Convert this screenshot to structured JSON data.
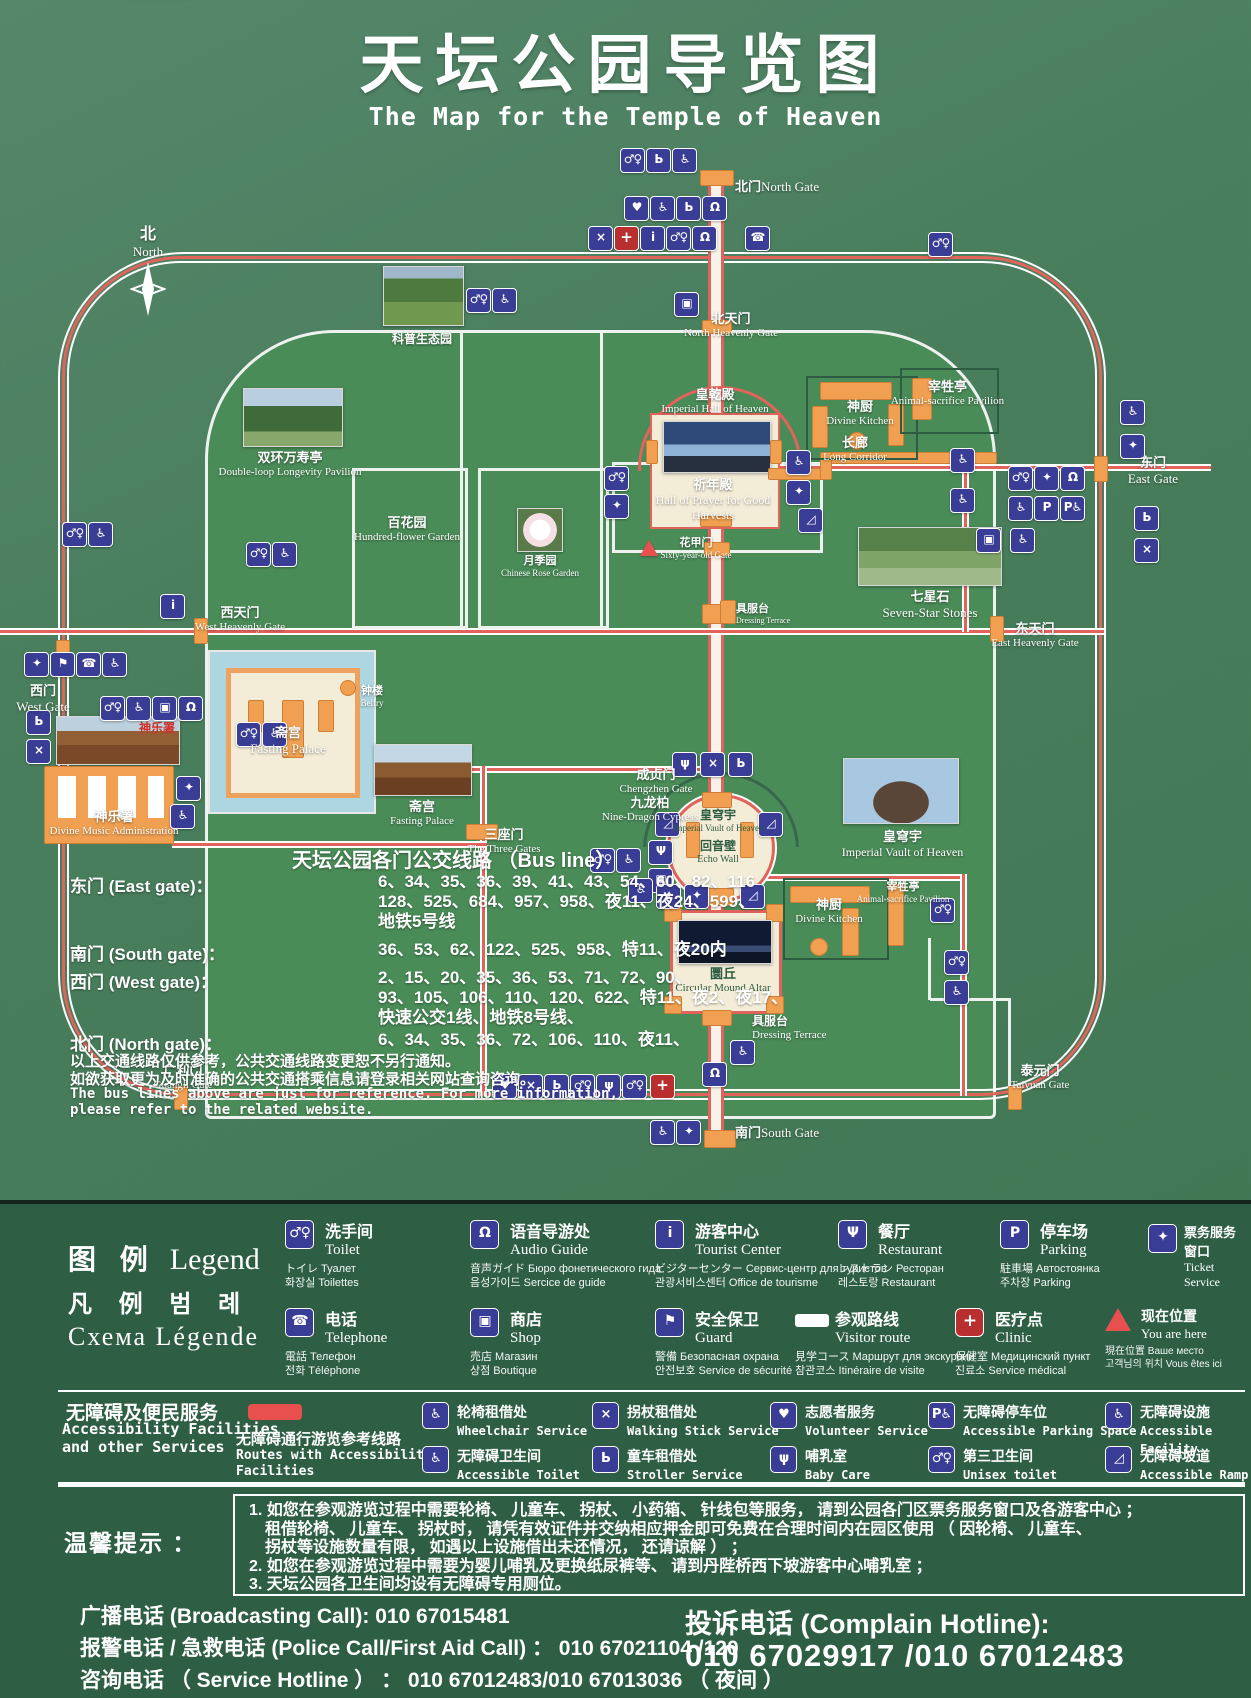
{
  "title": {
    "zh": "天坛公园导览图",
    "en": "The Map for the Temple of Heaven"
  },
  "colors": {
    "board_green": "#4a7f5e",
    "park_green": "#4a8c58",
    "panel_green": "#2e5f44",
    "route_red": "#e0635c",
    "icon_blue": "#3a3d96",
    "building_orange": "#f0a050",
    "moat_blue": "#aed6e0",
    "cream": "#f3ecd7",
    "marker_red": "#e85050"
  },
  "icons": {
    "toilet": "♂♀",
    "acc_toilet": "♿",
    "accessible": "♿",
    "wheelchair": "♿",
    "phone": "☎",
    "info": "i",
    "restaurant": "Ψ",
    "parking": "P",
    "acc_parking": "P♿",
    "ticket": "✦",
    "audio": "Ω",
    "shop": "▣",
    "guard": "⚑",
    "clinic": "+",
    "volunteer": "♥",
    "walking": "×",
    "stroller": "Ь",
    "baby": "ψ",
    "unisex": "♂♀",
    "ramp": "◿"
  },
  "features": {
    "compass": {
      "zh": "北",
      "en": "North"
    },
    "north_gate": {
      "zh": "北门",
      "en": "North Gate"
    },
    "north_heavenly": {
      "zh": "北天门",
      "en": "North Heavenly Gate"
    },
    "science_garden": {
      "zh": "科普生态园",
      "en": ""
    },
    "double_loop": {
      "zh": "双环万寿亭",
      "en": "Double-loop Longevity Pavilion"
    },
    "imperial_hall": {
      "zh": "皇乾殿",
      "en": "Imperial Hall of Heaven"
    },
    "hall_prayer": {
      "zh": "祈年殿",
      "en": "Hall of Prayer for Good Harvests"
    },
    "divine_kitchen": {
      "zh": "神厨",
      "en": "Divine Kitchen"
    },
    "animal_pavilion": {
      "zh": "宰牲亭",
      "en": "Animal-sacrifice Pavilion"
    },
    "long_corridor": {
      "zh": "长廊",
      "en": "Long Corridor"
    },
    "east_gate": {
      "zh": "东门",
      "en": "East Gate"
    },
    "hundred_flower": {
      "zh": "百花园",
      "en": "Hundred-flower Garden"
    },
    "rose_garden": {
      "zh": "月季园",
      "en": "Chinese Rose Garden"
    },
    "sixty_gate": {
      "zh": "花甲门",
      "en": "Sixty-year-old Gate"
    },
    "seven_star": {
      "zh": "七星石",
      "en": "Seven-Star Stones"
    },
    "west_heavenly": {
      "zh": "西天门",
      "en": "West Heavenly Gate"
    },
    "west_gate": {
      "zh": "西门",
      "en": "West Gate"
    },
    "east_heavenly": {
      "zh": "东天门",
      "en": "East Heavenly Gate"
    },
    "dressing": {
      "zh": "具服台",
      "en": "Dressing Terrace"
    },
    "belfry": {
      "zh": "钟楼",
      "en": "Belfry"
    },
    "fasting_palace": {
      "zh": "斋宫",
      "en": "Fasting Palace"
    },
    "divine_music": {
      "zh": "神乐署",
      "en": "Divine Music Administration"
    },
    "chengzhen": {
      "zh": "成贞门",
      "en": "Chengzhen Gate"
    },
    "nine_dragon": {
      "zh": "九龙柏",
      "en": "Nine-Dragon Cypress"
    },
    "imperial_vault": {
      "zh": "皇穹宇",
      "en": "Imperial Vault of Heaven"
    },
    "echo_wall": {
      "zh": "回音壁",
      "en": "Echo Wall"
    },
    "three_gates": {
      "zh": "三座门",
      "en": "The Three Gates"
    },
    "circular_mound": {
      "zh": "圜丘",
      "en": "Circular Mound Altar"
    },
    "taiyuan": {
      "zh": "泰元门",
      "en": "Taiyuan Gate"
    },
    "guangli": {
      "zh": "广利门",
      "en": "Guangli Gate"
    },
    "south_gate": {
      "zh": "南门",
      "en": "South Gate"
    }
  },
  "bus": {
    "title": "天坛公园各门公交线路 （Bus line）",
    "rows": [
      {
        "label": "东门 (East gate)：",
        "value": "6、34、35、36、39、41、43、54、60、82、116\n128、525、684、957、958、夜11、夜24、599、\n地铁5号线"
      },
      {
        "label": "南门 (South gate)：",
        "value": "36、53、62、122、525、958、特11、夜20内"
      },
      {
        "label": "西门 (West gate)：",
        "value": "2、15、20、35、36、53、71、72、90、\n93、105、106、110、120、622、特11、夜2、夜17、\n快速公交1线、地铁8号线、"
      },
      {
        "label": "北门 (North gate)：",
        "value": "6、34、35、36、72、106、110、夜11、"
      }
    ],
    "notes": [
      "以上交通线路仅供参考，公共交通线路变更恕不另行通知。",
      "如欲获取更为及时准确的公共交通搭乘信息请登录相关网站查询咨询。",
      "The bus lines above are just for reference. For more information,",
      "please refer to the related website."
    ]
  },
  "legend": {
    "header": {
      "l1z": "图 例",
      "l1e": "Legend",
      "l2": "凡 例 범 례",
      "l3": "Схема Légende"
    },
    "items": [
      {
        "zh": "洗手间",
        "en": "Toilet",
        "l3": "トイレ Туалет",
        "l4": "화장실 Toilettes"
      },
      {
        "zh": "语音导游处",
        "en": "Audio Guide",
        "l3": "音声ガイド Бюро фонетического гида",
        "l4": "음성가이드 Sercice de guide"
      },
      {
        "zh": "游客中心",
        "en": "Tourist Center",
        "l3": "ビジターセンター Сервис-центр для туристов",
        "l4": "관광서비스센터 Office de tourisme"
      },
      {
        "zh": "餐厅",
        "en": "Restaurant",
        "l3": "レストラン Ресторан",
        "l4": "레스토랑 Restaurant"
      },
      {
        "zh": "停车场",
        "en": "Parking",
        "l3": "駐車場 Автостоянка",
        "l4": "주차장 Parking"
      },
      {
        "zh": "票务服务窗口",
        "en": "Ticket Service",
        "l3": "",
        "l4": ""
      },
      {
        "zh": "电话",
        "en": "Telephone",
        "l3": "電話 Телефон",
        "l4": "전화 Téléphone"
      },
      {
        "zh": "商店",
        "en": "Shop",
        "l3": "売店 Магазин",
        "l4": "상점 Boutique"
      },
      {
        "zh": "安全保卫",
        "en": "Guard",
        "l3": "警備 Безопасная охрана",
        "l4": "안전보호 Service de sécurité"
      },
      {
        "zh": "参观路线",
        "en": "Visitor route",
        "l3": "見学コース Маршрут для экскурсии",
        "l4": "참관코스 Itinéraire de visite"
      },
      {
        "zh": "医疗点",
        "en": "Clinic",
        "l3": "保健室 Медицинский пункт",
        "l4": "진료소 Service médical"
      },
      {
        "zh": "现在位置",
        "en": "You are here",
        "l3": "現在位置 Ваше место",
        "l4": "고객님의 위치 Vous êtes ici"
      }
    ]
  },
  "access": {
    "header_zh": "无障碍及便民服务",
    "header_en": "Accessibility Facilities\nand other Services",
    "route_zh": "无障碍通行游览参考线路",
    "route_en": "Routes with Accessibility\nFacilities",
    "items": [
      {
        "zh": "轮椅租借处",
        "en": "Wheelchair Service"
      },
      {
        "zh": "拐杖租借处",
        "en": "Walking Stick Service"
      },
      {
        "zh": "志愿者服务",
        "en": "Volunteer Service"
      },
      {
        "zh": "无障碍停车位",
        "en": "Accessible Parking Space"
      },
      {
        "zh": "无障碍设施",
        "en": "Accessible Facility"
      },
      {
        "zh": "无障碍卫生间",
        "en": "Accessible Toilet"
      },
      {
        "zh": "童车租借处",
        "en": "Stroller Service"
      },
      {
        "zh": "哺乳室",
        "en": "Baby Care"
      },
      {
        "zh": "第三卫生间",
        "en": "Unisex toilet"
      },
      {
        "zh": "无障碍坡道",
        "en": "Accessible Ramp"
      }
    ]
  },
  "tips": {
    "label": "温馨提示 ：",
    "lines": [
      "1. 如您在参观游览过程中需要轮椅、 儿童车、 拐杖、 小药箱、 针线包等服务， 请到公园各门区票务服务窗口及各游客中心 ；",
      "租借轮椅、 儿童车、 拐杖时， 请凭有效证件并交纳相应押金即可免费在合理时间内在园区使用 （ 因轮椅、 儿童车、",
      "拐杖等设施数量有限， 如遇以上设施借出未还情况， 还请谅解 ） ；",
      "2. 如您在参观游览过程中需要为婴儿哺乳及更换纸尿裤等、 请到丹陛桥西下坡游客中心哺乳室 ；",
      "3. 天坛公园各卫生间均设有无障碍专用厕位。"
    ]
  },
  "phones": {
    "broadcasting": "广播电话 (Broadcasting Call):  010 67015481",
    "police": "报警电话 / 急救电话 (Police Call/First Aid Call) ：  010 67021104 /120",
    "service": "咨询电话 （ Service Hotline ） ： 010 67012483/010 67013036 （ 夜间 ）",
    "complain_label": "投诉电话 (Complain Hotline):",
    "complain_value": "010 67029917 /010 67012483"
  }
}
